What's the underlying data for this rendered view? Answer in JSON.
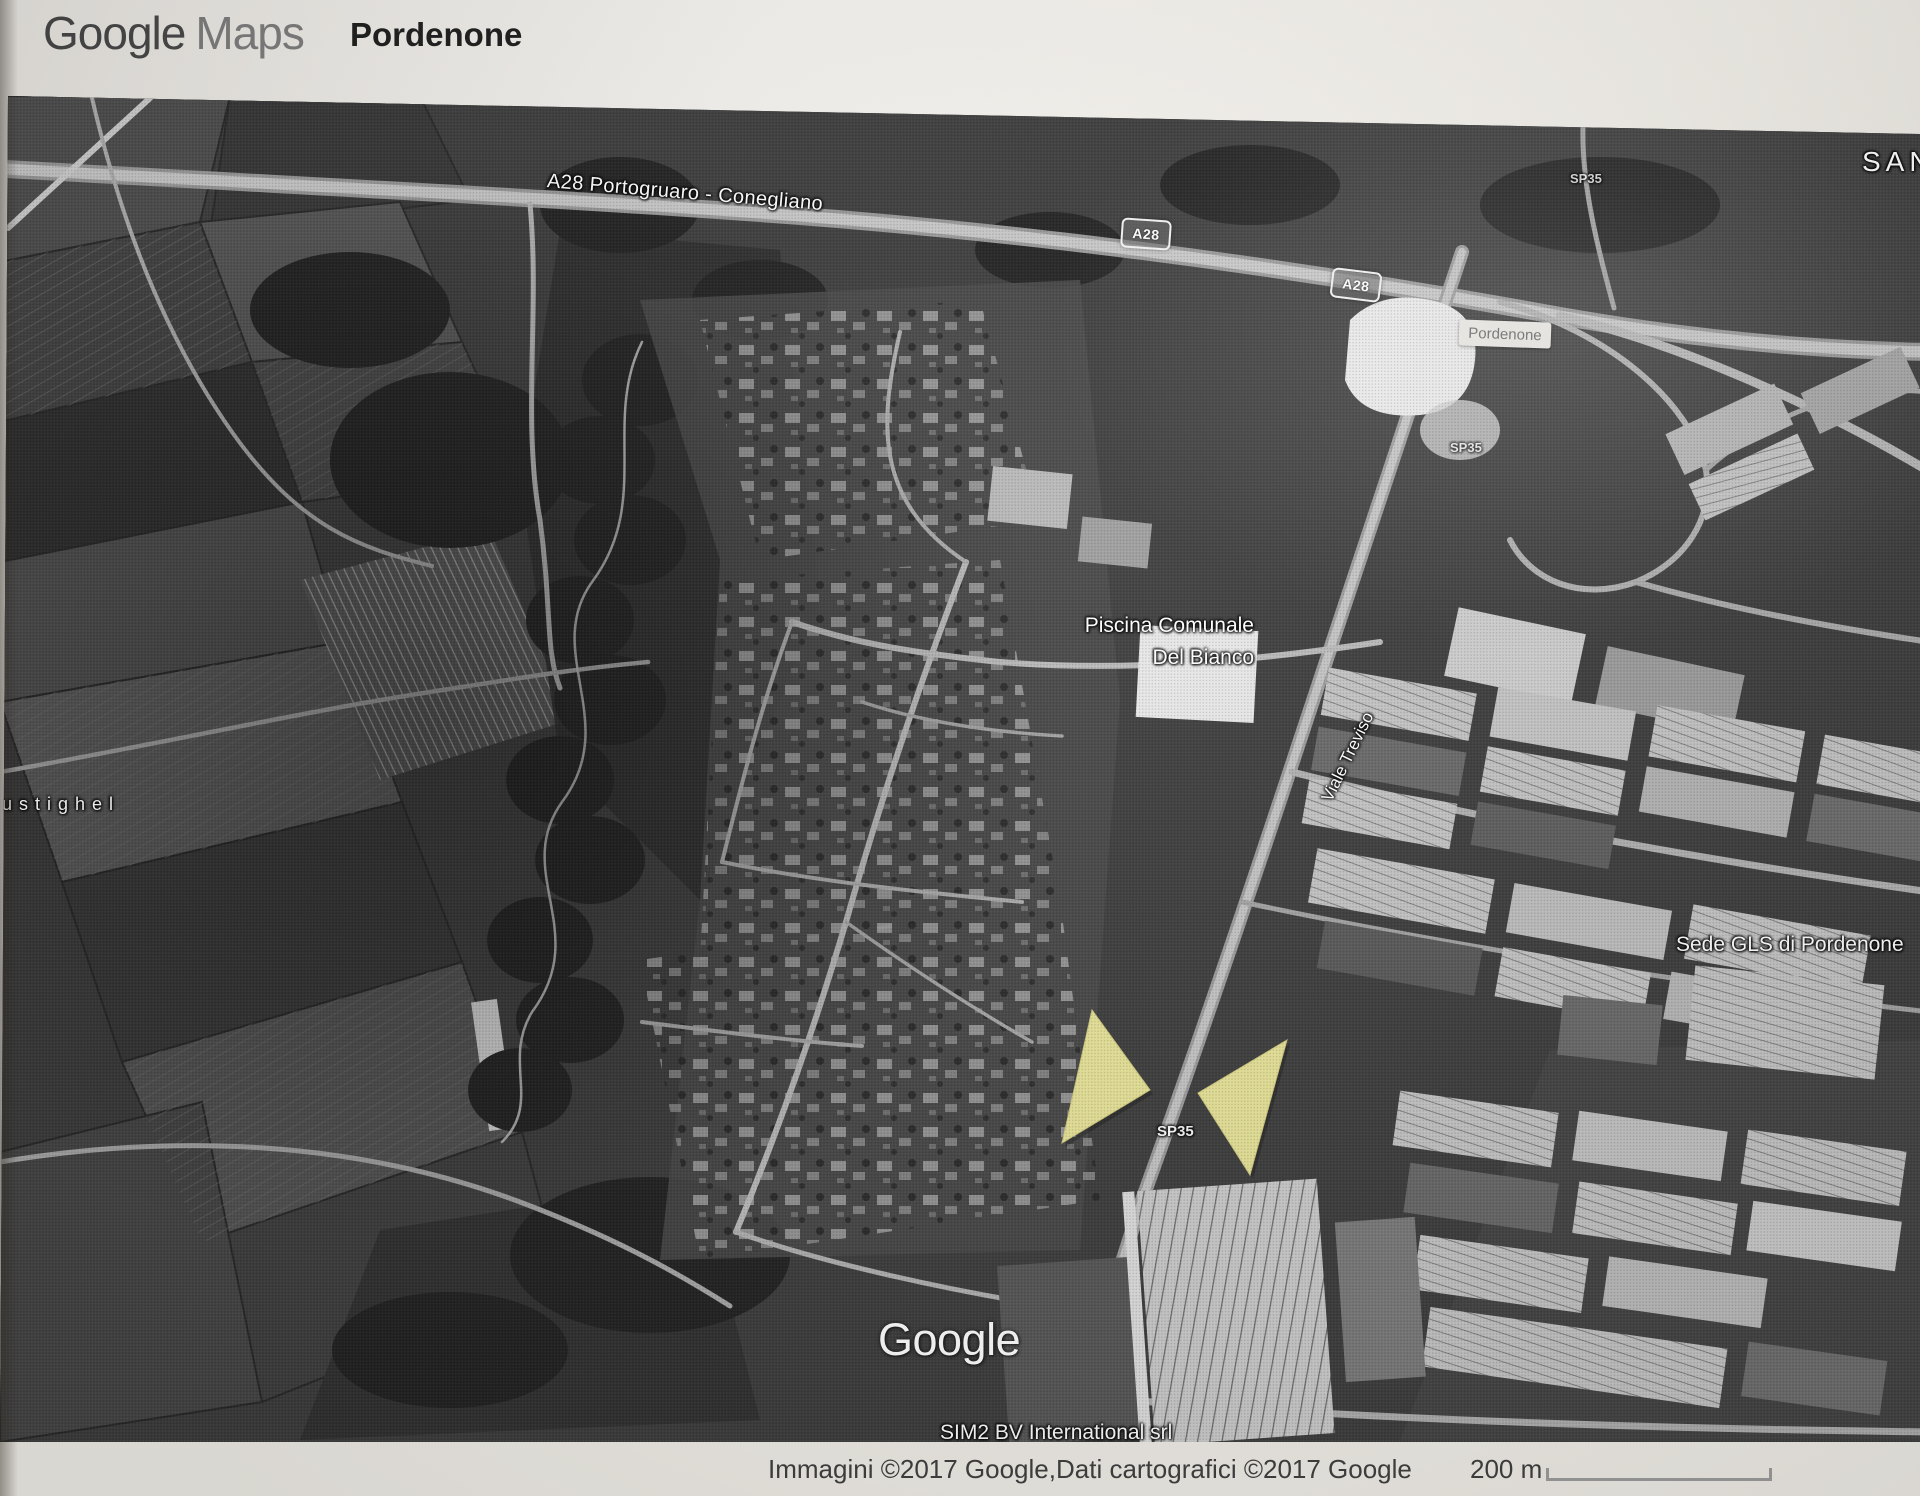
{
  "header": {
    "logo_part1": "Google",
    "logo_part2": "Maps",
    "title": "Pordenone"
  },
  "map_labels": {
    "a28_road": "A28 Portogruaro - Conegliano",
    "a28_badge_1": "A28",
    "a28_badge_2": "A28",
    "town_pill": "Pordenone",
    "sp35_top": "SP35",
    "sp35_mid": "SP35",
    "sp35_bottom": "SP35",
    "san_partial": "SAN",
    "piscina_line1": "Piscina Comunale",
    "piscina_line2": "Del Bianco",
    "viale_treviso": "Viale Treviso",
    "sede_gls": "Sede GLS di Pordenone",
    "ustighel": "ustighel",
    "google_watermark": "Google",
    "sim2": "SIM2 BV International srl"
  },
  "markers": {
    "left_triangle": "yellow-triangle-marker",
    "right_triangle": "yellow-triangle-marker"
  },
  "footer": {
    "attribution": "Immagini ©2017 Google,Dati cartografici ©2017 Google",
    "scale_label": "200 m"
  },
  "colors": {
    "marker_yellow": "#e9e59a",
    "marker_yellow_edge": "#d3cf7f",
    "label_white": "#ffffff",
    "town_pill_bg": "#edebe7",
    "footer_bg": "#f2efe9"
  }
}
